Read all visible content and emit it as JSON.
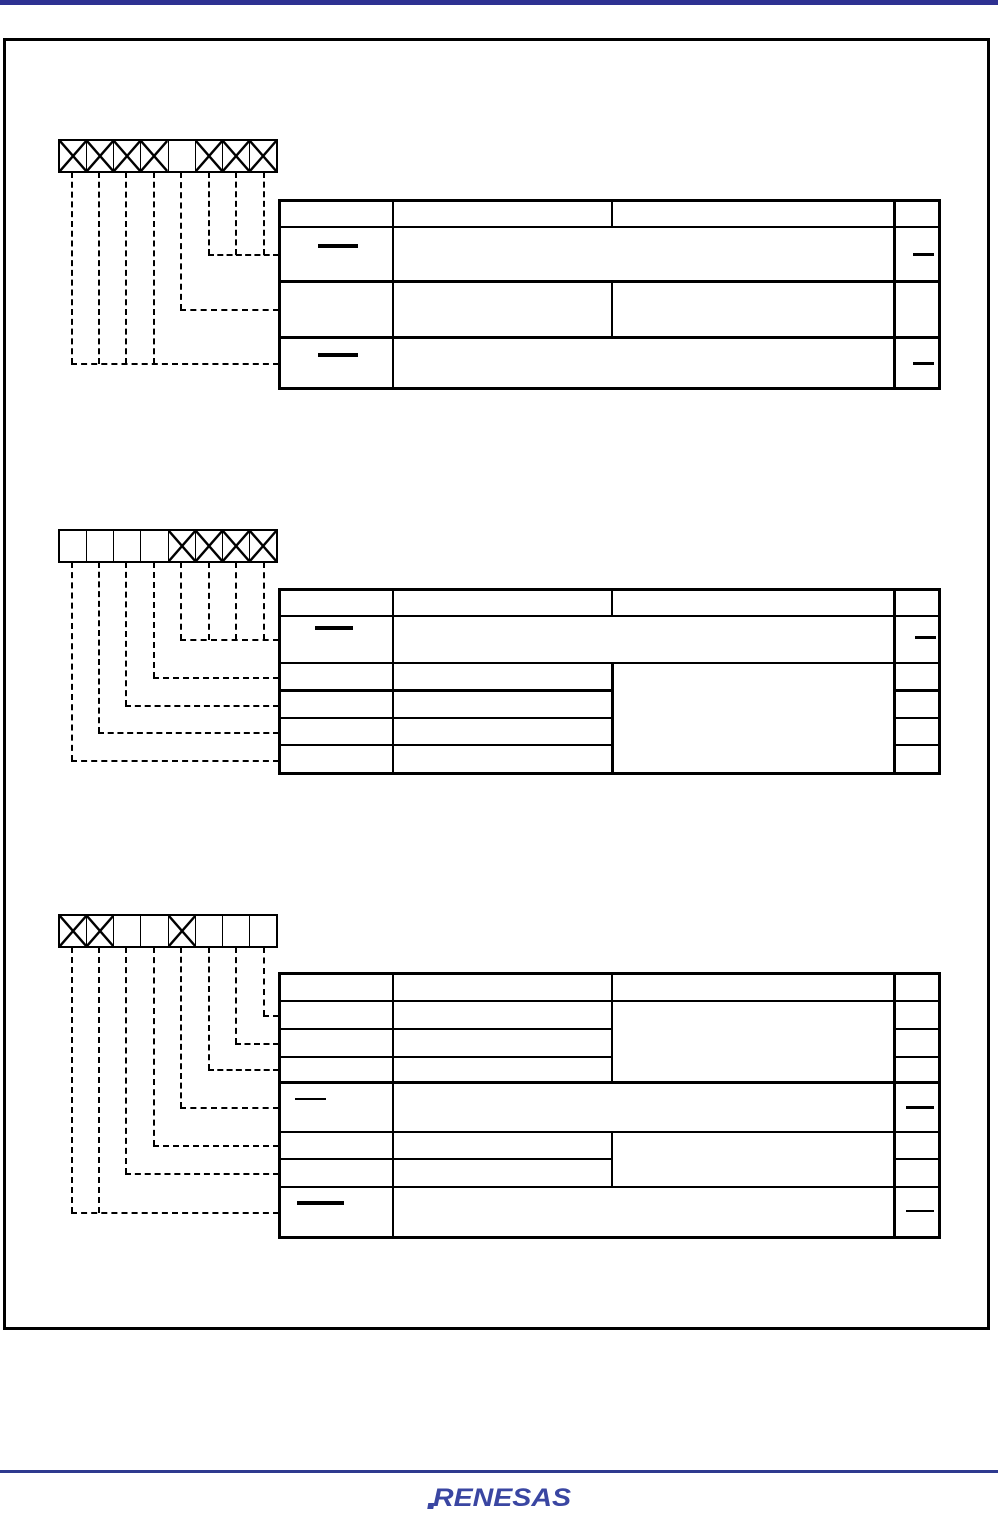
{
  "document": {
    "type": "register-bit-description-page",
    "visible_text": [
      "RENESAS"
    ]
  },
  "colors": {
    "accent_bar": "#2E3192",
    "footer_rule": "#2E3A8F",
    "logo": "#3A46A2",
    "line": "#000000"
  },
  "footer": {
    "logo_text": "RENESAS"
  },
  "dash_glyph": "—",
  "registers": [
    {
      "id": 1,
      "bit_boxes": [
        "x",
        "x",
        "x",
        "x",
        "blank",
        "x",
        "x",
        "x"
      ],
      "connections": [
        {
          "boxes": [
            1,
            2,
            3,
            4
          ],
          "table_row": 4
        },
        {
          "boxes": [
            5
          ],
          "table_row": 3
        },
        {
          "boxes": [
            6,
            7,
            8
          ],
          "table_row": 2
        }
      ],
      "table": {
        "columns": 4,
        "rows": [
          {
            "row": 1,
            "type": "header"
          },
          {
            "row": 2,
            "type": "reserved",
            "col1": "—",
            "middle": "merged",
            "col4": "—"
          },
          {
            "row": 3,
            "type": "field"
          },
          {
            "row": 4,
            "type": "reserved",
            "col1": "—",
            "middle": "merged",
            "col4": "—"
          }
        ]
      }
    },
    {
      "id": 2,
      "bit_boxes": [
        "blank",
        "blank",
        "blank",
        "blank",
        "x",
        "x",
        "x",
        "x"
      ],
      "connections": [
        {
          "boxes": [
            5,
            6,
            7,
            8
          ],
          "table_row": 2
        },
        {
          "boxes": [
            4
          ],
          "table_row": 3
        },
        {
          "boxes": [
            3
          ],
          "table_row": 4
        },
        {
          "boxes": [
            2
          ],
          "table_row": 5
        },
        {
          "boxes": [
            1
          ],
          "table_row": 6
        }
      ],
      "table": {
        "columns": 4,
        "rows": [
          {
            "row": 1,
            "type": "header"
          },
          {
            "row": 2,
            "type": "reserved",
            "col1": "—",
            "middle": "merged",
            "col4": "—"
          },
          {
            "row": 3,
            "type": "field"
          },
          {
            "row": 4,
            "type": "field"
          },
          {
            "row": 5,
            "type": "field"
          },
          {
            "row": 6,
            "type": "field"
          }
        ],
        "col3_merged_rows": [
          [
            3,
            6
          ]
        ]
      }
    },
    {
      "id": 3,
      "bit_boxes": [
        "x",
        "x",
        "blank",
        "blank",
        "x",
        "blank",
        "blank",
        "blank"
      ],
      "connections": [
        {
          "boxes": [
            8
          ],
          "table_row": 2
        },
        {
          "boxes": [
            7
          ],
          "table_row": 3
        },
        {
          "boxes": [
            6
          ],
          "table_row": 4
        },
        {
          "boxes": [
            5
          ],
          "table_row": 5
        },
        {
          "boxes": [
            4
          ],
          "table_row": 6
        },
        {
          "boxes": [
            3
          ],
          "table_row": 7
        },
        {
          "boxes": [
            1,
            2
          ],
          "table_row": 8
        }
      ],
      "table": {
        "columns": 4,
        "rows": [
          {
            "row": 1,
            "type": "header"
          },
          {
            "row": 2,
            "type": "field"
          },
          {
            "row": 3,
            "type": "field"
          },
          {
            "row": 4,
            "type": "field"
          },
          {
            "row": 5,
            "type": "reserved",
            "col1": "—",
            "middle": "merged",
            "col4": "—"
          },
          {
            "row": 6,
            "type": "field"
          },
          {
            "row": 7,
            "type": "field"
          },
          {
            "row": 8,
            "type": "reserved",
            "col1": "—",
            "middle": "merged",
            "col4": "—"
          }
        ],
        "col3_merged_rows": [
          [
            2,
            4
          ],
          [
            6,
            7
          ]
        ]
      }
    }
  ]
}
